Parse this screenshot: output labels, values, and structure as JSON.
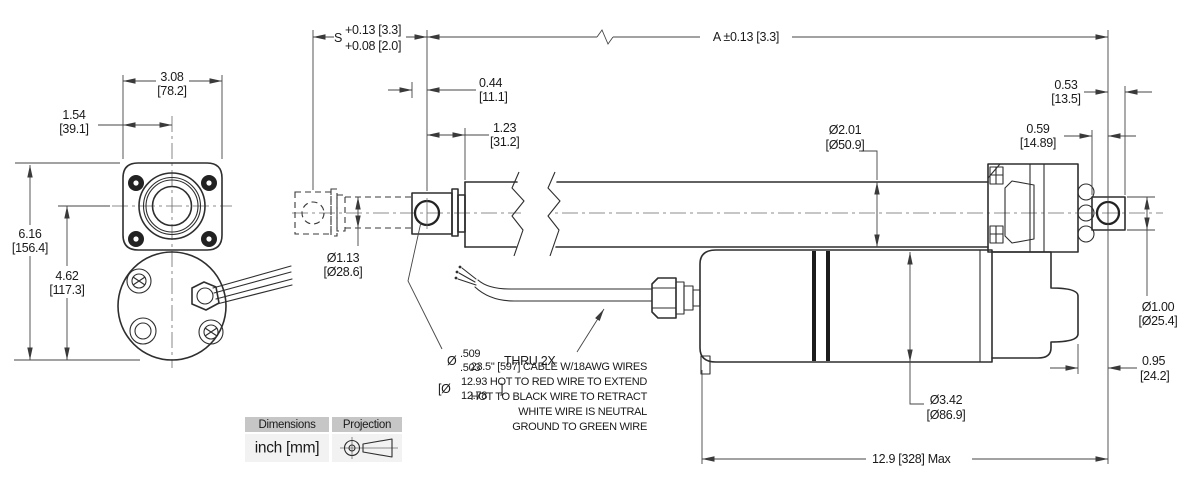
{
  "page": {
    "background": "#ffffff",
    "line_color": "#2e2e2e"
  },
  "front_view": {
    "width_in": "3.08",
    "width_mm": "[78.2]",
    "half_width_in": "1.54",
    "half_width_mm": "[39.1]",
    "height_in": "6.16",
    "height_mm": "[156.4]",
    "motor_height_in": "4.62",
    "motor_height_mm": "[117.3]"
  },
  "side_view": {
    "stroke_label": "S",
    "stroke_tol_upper": "+0.13 [3.3]",
    "stroke_tol_lower": "+0.08 [2.0]",
    "length_a": "A ±0.13 [3.3]",
    "pin_offset_in": "0.44",
    "pin_offset_mm": "[11.1]",
    "clevis_to_tube_in": "1.23",
    "clevis_to_tube_mm": "[31.2]",
    "tube_dia_in": "Ø2.01",
    "tube_dia_mm": "[Ø50.9]",
    "rod_dia_in": "Ø1.13",
    "rod_dia_mm": "[Ø28.6]",
    "hole_dia_symbol": "Ø",
    "hole_upper": ".509",
    "hole_lower": ".503",
    "hole_suffix": "THRU 2X",
    "hole_mm_open": "[Ø",
    "hole_mm_upper": "12.93",
    "hole_mm_lower": "12.78",
    "hole_mm_close": "]",
    "rear_hole_to_end_in": "0.53",
    "rear_hole_to_end_mm": "[13.5]",
    "rear_face_to_hole_in": "0.59",
    "rear_face_to_hole_mm": "[14.89]",
    "rear_pin_dia_in": "Ø1.00",
    "rear_pin_dia_mm": "[Ø25.4]",
    "motor_dia_in": "Ø3.42",
    "motor_dia_mm": "[Ø86.9]",
    "rear_overhang_in": "0.95",
    "rear_overhang_mm": "[24.2]",
    "overall_max": "12.9 [328] Max"
  },
  "cable_note": {
    "line1": "23.5\" [597] CABLE W/18AWG WIRES",
    "line2": "HOT TO RED WIRE TO EXTEND",
    "line3": "HOT TO BLACK WIRE TO RETRACT",
    "line4": "WHITE WIRE IS NEUTRAL",
    "line5": "GROUND TO GREEN WIRE"
  },
  "legend": {
    "dimensions_label": "Dimensions",
    "dimensions_value": "inch [mm]",
    "projection_label": "Projection"
  }
}
